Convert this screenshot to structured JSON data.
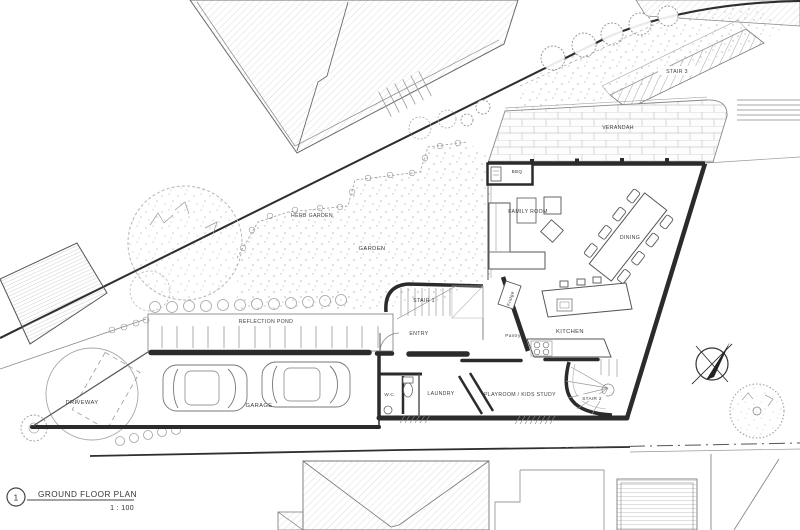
{
  "sheet": {
    "number": "1",
    "title": "GROUND FLOOR PLAN",
    "scale": "1 : 100"
  },
  "rooms": {
    "verandah": "VERANDAH",
    "bbq": "BBQ",
    "family_room": "FAMILY ROOM",
    "dining": "DINING",
    "kitchen": "KITCHEN",
    "pantry": "Pantry",
    "fridge": "Fridge",
    "entry": "ENTRY",
    "laundry": "LAUNDRY",
    "wc": "W.C.",
    "playroom": "PLAYROOM / KIDS STUDY",
    "garage": "GARAGE"
  },
  "stairs": {
    "stair1": "STAIR 1",
    "stair2": "STAIR 2",
    "stair3": "STAIR 3"
  },
  "site": {
    "garden": "GARDEN",
    "herb_garden": "HERB GARDEN",
    "reflection_pond": "REFLECTION POND",
    "driveway": "DRIVEWAY"
  },
  "colors": {
    "paper": "#ffffff",
    "ink": "#2b2b2b",
    "line_medium": "#555555",
    "line_light": "#9a9a9a",
    "hatch": "#c9c9c9"
  }
}
